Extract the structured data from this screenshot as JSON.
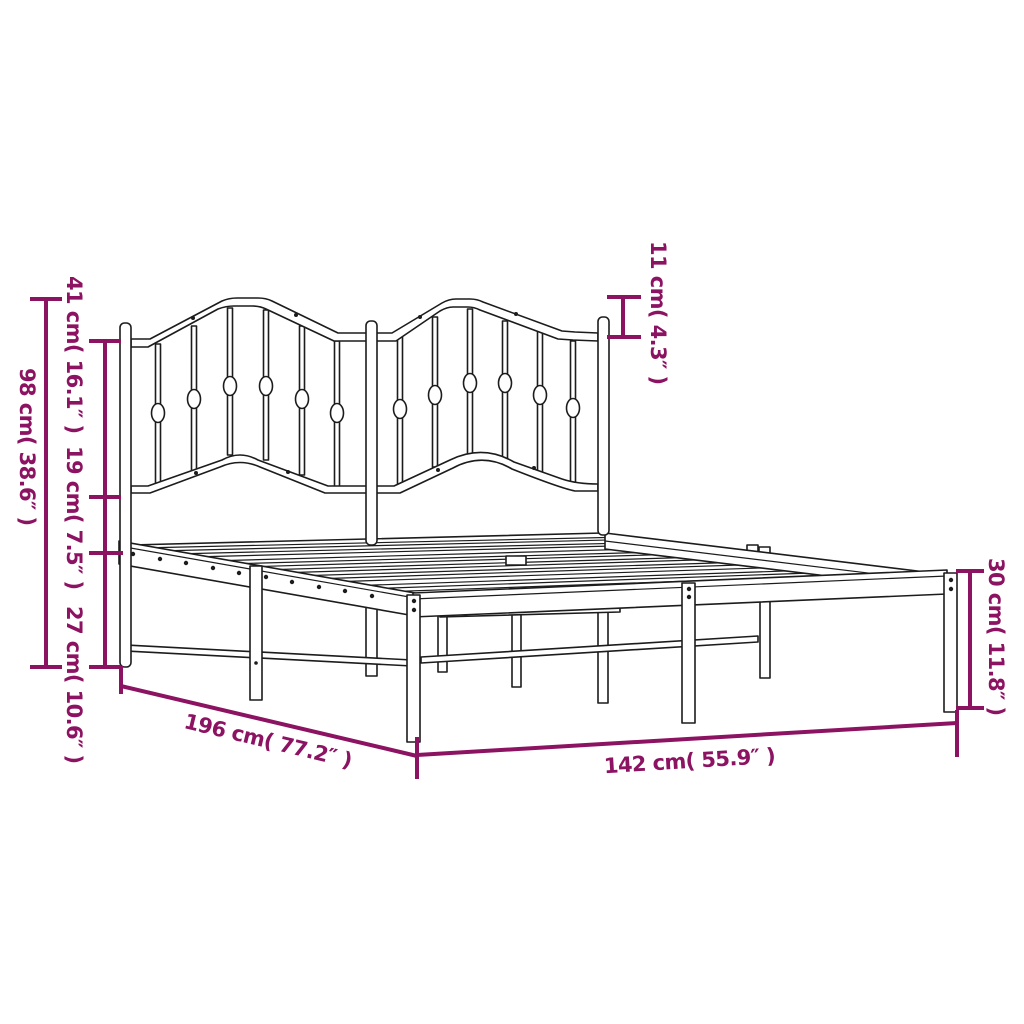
{
  "diagram": {
    "title": "Metal bed frame with headboard - dimension drawing",
    "product": "metal-bed-frame-with-headboard",
    "colors": {
      "dimension_accent": "#8C1262",
      "outline": "#1C1C1C",
      "background": "#FFFFFF"
    },
    "labels": {
      "overall_height": "98 cm( 38.6″ )",
      "headboard_panel_height": "41 cm( 16.1″ )",
      "headboard_to_base_gap": "19 cm( 7.5″ )",
      "base_clearance": "27 cm( 10.6″ )",
      "headboard_peak_height": "11 cm( 4.3″ )",
      "frame_side_height": "30 cm( 11.8″ )",
      "frame_length": "196 cm( 77.2″ )",
      "frame_width": "142 cm( 55.9″ )"
    },
    "measurements": [
      {
        "name": "overall height",
        "cm": 98,
        "inches": 38.6
      },
      {
        "name": "headboard panel height",
        "cm": 41,
        "inches": 16.1
      },
      {
        "name": "headboard to base gap",
        "cm": 19,
        "inches": 7.5
      },
      {
        "name": "under-bed clearance",
        "cm": 27,
        "inches": 10.6
      },
      {
        "name": "headboard peak height",
        "cm": 11,
        "inches": 4.3
      },
      {
        "name": "frame side height",
        "cm": 30,
        "inches": 11.8
      },
      {
        "name": "frame length",
        "cm": 196,
        "inches": 77.2
      },
      {
        "name": "frame width",
        "cm": 142,
        "inches": 55.9
      }
    ]
  }
}
